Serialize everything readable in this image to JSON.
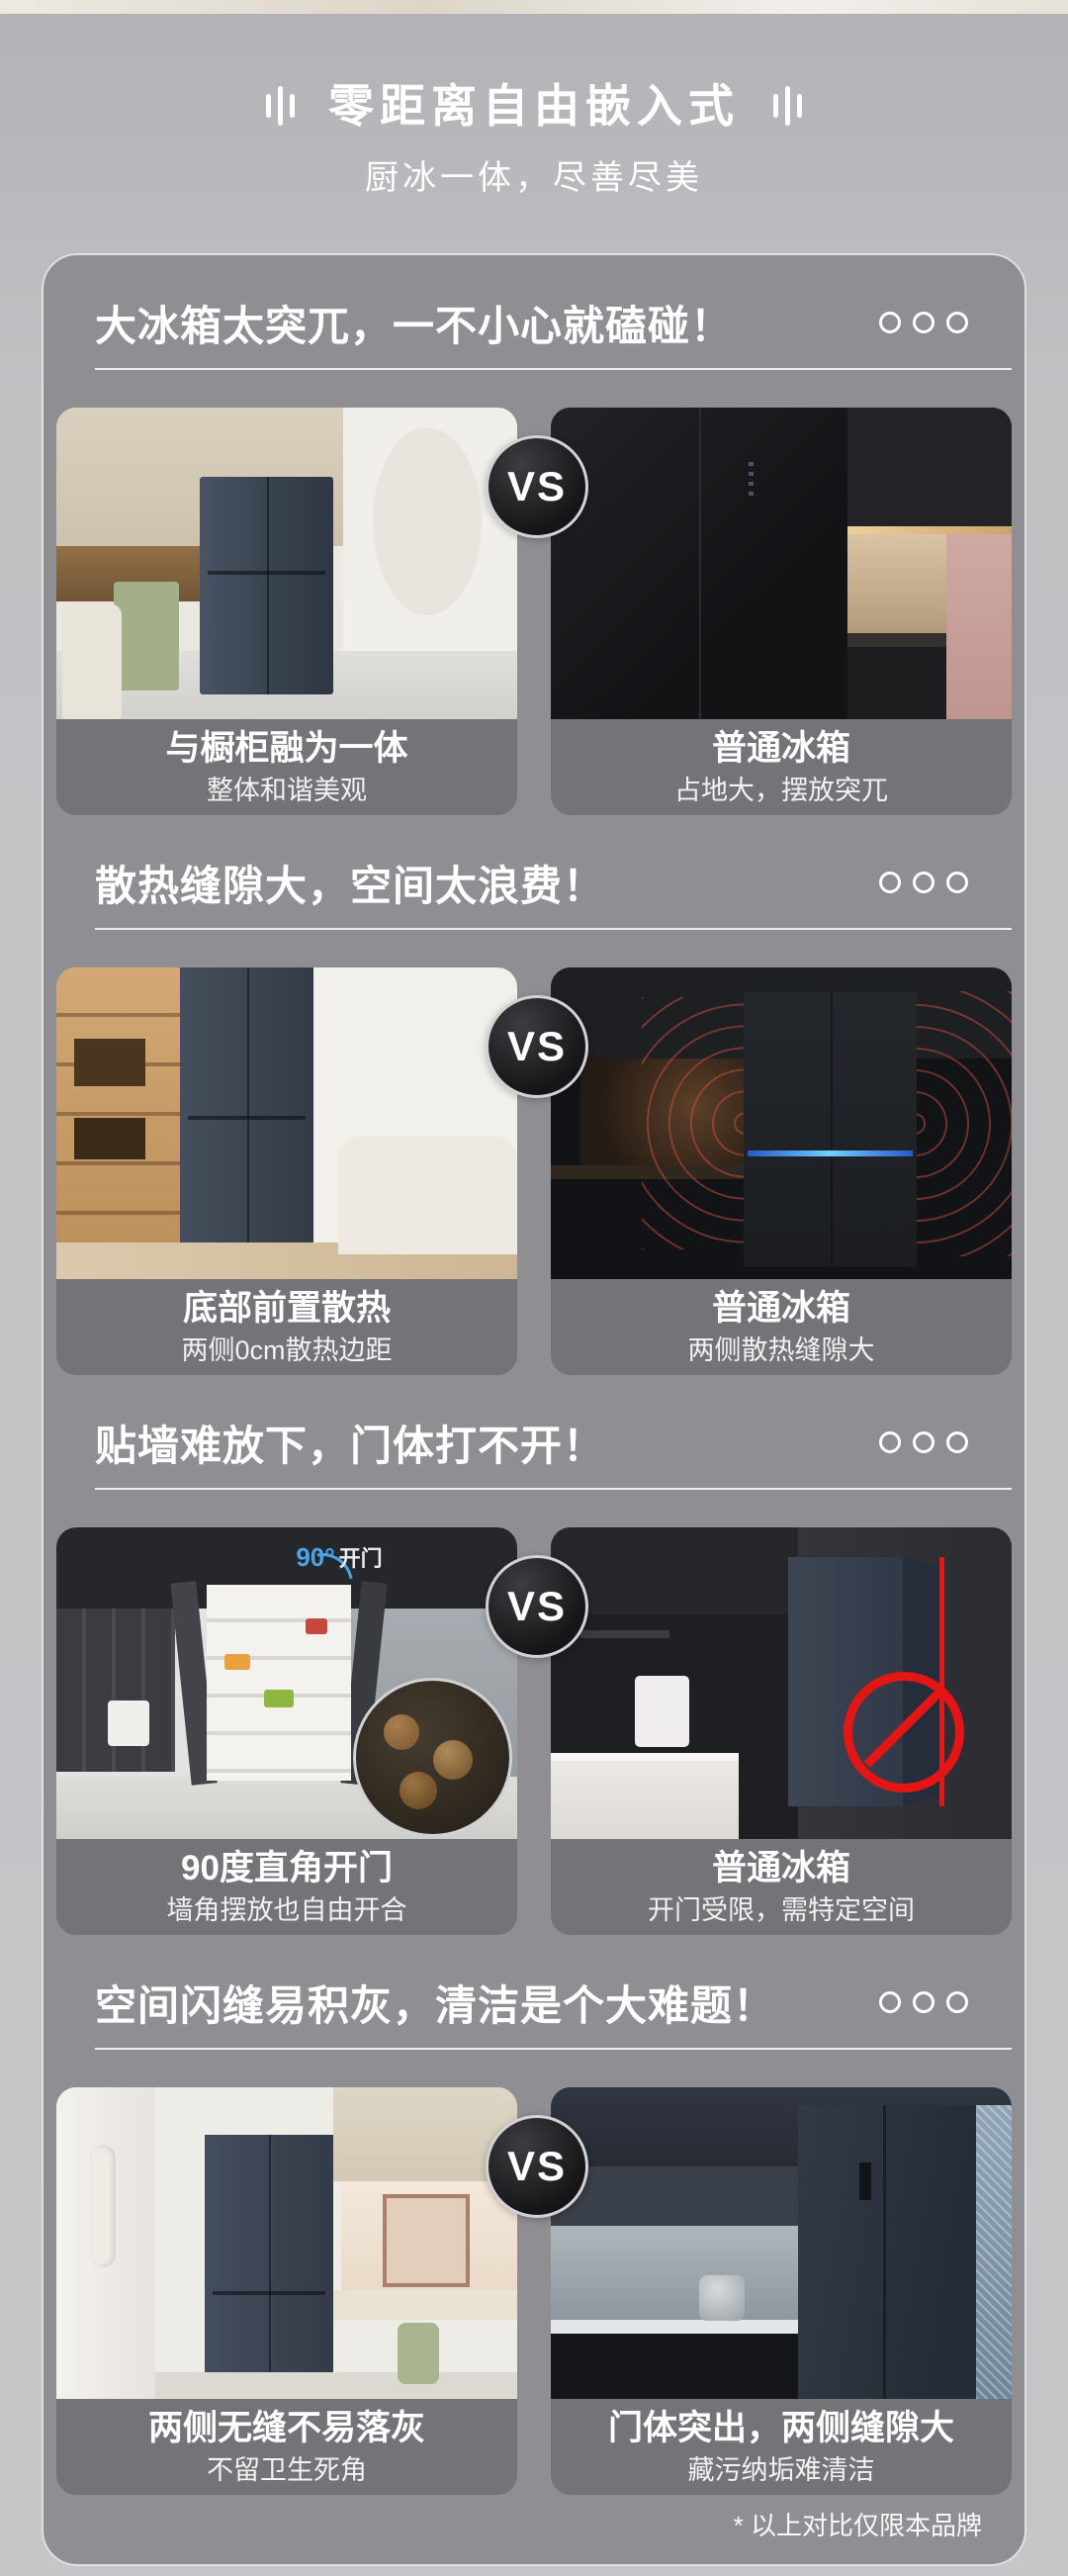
{
  "page": {
    "header": {
      "title": "零距离自由嵌入式",
      "subtitle": "厨冰一体，尽善尽美"
    },
    "vs_label": "VS",
    "footnote": "* 以上对比仅限本品牌",
    "icons": {
      "section_more": "three-outline-circles",
      "vs_badge": "vs-dark-circle",
      "prohibition": "no-entry-red-circle",
      "title_decoration": "triple-vertical-bars"
    },
    "colors": {
      "page_background": "#c2c2c5",
      "card_background": "#8f8f93",
      "caption_panel": "#747478",
      "text": "#ffffff",
      "alert_red": "#e31515",
      "led_blue": "#6fd0ff",
      "annotation_blue": "#4aa3e8"
    },
    "sections": [
      {
        "title": "大冰箱太突兀，一不小心就磕碰！",
        "left": {
          "caption_title": "与橱柜融为一体",
          "caption_sub": "整体和谐美观"
        },
        "right": {
          "caption_title": "普通冰箱",
          "caption_sub": "占地大，摆放突兀"
        }
      },
      {
        "title": "散热缝隙大，空间太浪费！",
        "left": {
          "caption_title": "底部前置散热",
          "caption_sub": "两侧0cm散热边距"
        },
        "right": {
          "caption_title": "普通冰箱",
          "caption_sub": "两侧散热缝隙大"
        }
      },
      {
        "title": "贴墙难放下，门体打不开！",
        "left": {
          "caption_title": "90度直角开门",
          "caption_sub": "墙角摆放也自由开合",
          "annotation_deg": "90°",
          "annotation_text": "开门"
        },
        "right": {
          "caption_title": "普通冰箱",
          "caption_sub": "开门受限，需特定空间"
        }
      },
      {
        "title": "空间闪缝易积灰，清洁是个大难题！",
        "left": {
          "caption_title": "两侧无缝不易落灰",
          "caption_sub": "不留卫生死角"
        },
        "right": {
          "caption_title": "门体突出，两侧缝隙大",
          "caption_sub": "藏污纳垢难清洁"
        }
      }
    ]
  }
}
